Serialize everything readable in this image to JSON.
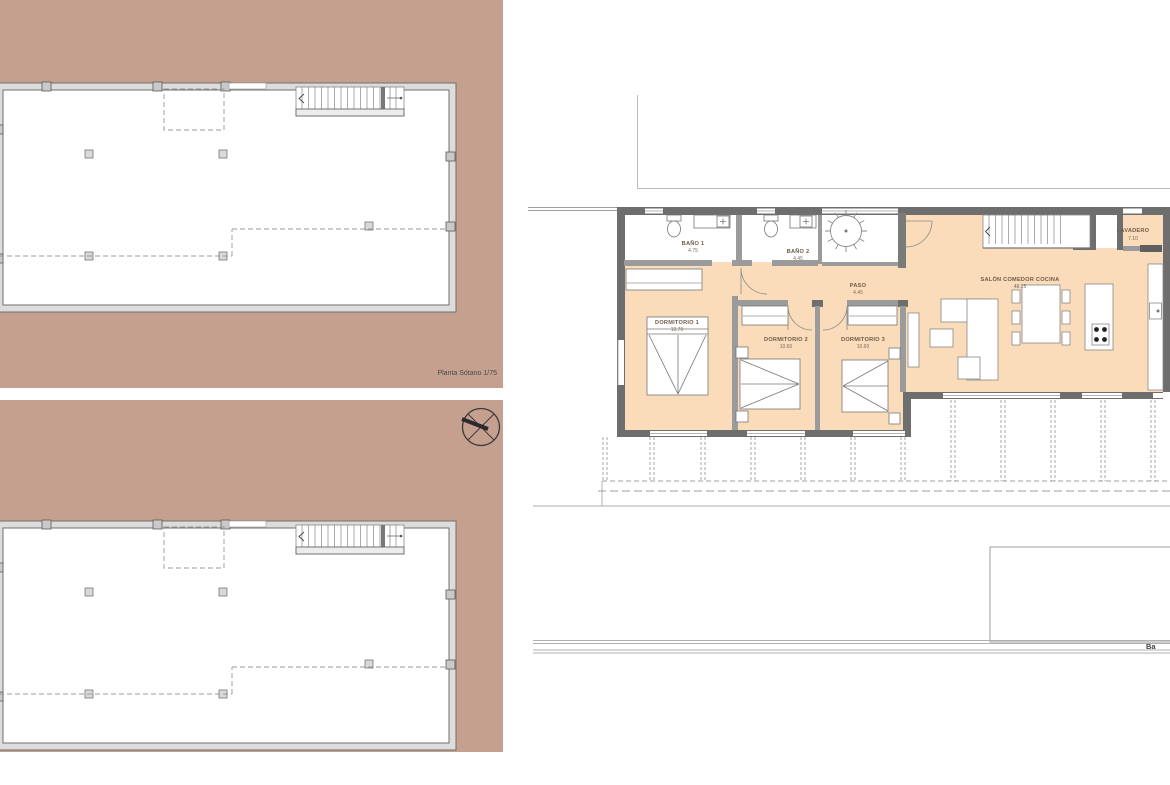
{
  "sheet": {
    "description_visible_text_only": ""
  },
  "colors": {
    "site_fill": "#c5a08e",
    "room_fill": "#fadcba",
    "wall_dark": "#6e6e6e",
    "wall_light": "#d9d9d9",
    "thin_line": "#999999",
    "label_text": "#6e5a4a"
  },
  "plan_sotano": {
    "caption": "Planta Sótano 1/75"
  },
  "plan_baja": {
    "caption_fragment": "Ba",
    "rooms": {
      "bano1": {
        "name": "BAÑO 1",
        "area": "4.75"
      },
      "bano2": {
        "name": "BAÑO 2",
        "area": "4.45"
      },
      "paso": {
        "name": "PASO",
        "area": "4.45"
      },
      "lavadero": {
        "name": "LAVADERO",
        "area": "7.10"
      },
      "salon": {
        "name": "SALÓN COMEDOR COCINA",
        "area": "48.15"
      },
      "dorm1": {
        "name": "DORMITORIO 1",
        "area": "12.70"
      },
      "dorm2": {
        "name": "DORMITORIO 2",
        "area": "10.60"
      },
      "dorm3": {
        "name": "DORMITORIO 3",
        "area": "10.60"
      }
    }
  }
}
